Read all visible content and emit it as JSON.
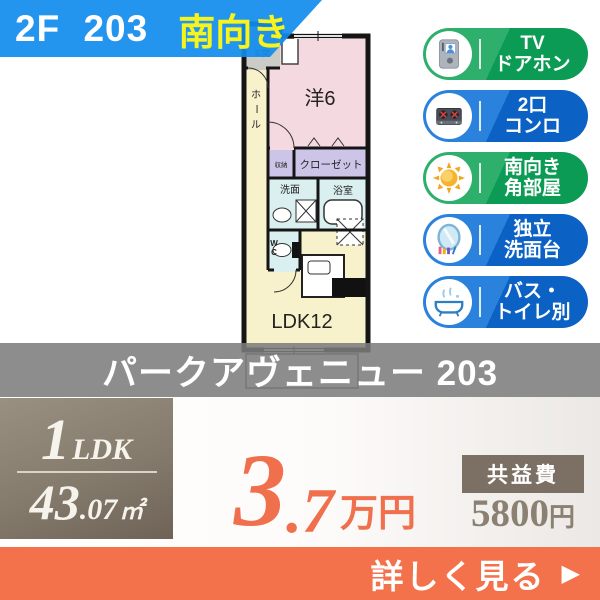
{
  "header": {
    "unit_label": "2F 203",
    "facing": "南向き"
  },
  "floorplan": {
    "rooms": {
      "entrance": "玄関",
      "hall": [
        "ホ",
        "ー",
        "ル"
      ],
      "western": "洋6",
      "storage": "収納",
      "closet": "クローゼット",
      "washroom": "洗面",
      "bath": "浴室",
      "wc": [
        "W",
        "C"
      ],
      "ldk": "LDK12"
    }
  },
  "features": [
    {
      "icon": "tv-doorphone",
      "color": "green",
      "lines": [
        "TV",
        "ドアホン"
      ]
    },
    {
      "icon": "two-burner-stove",
      "color": "blue",
      "lines": [
        "2口",
        "コンロ"
      ]
    },
    {
      "icon": "sun",
      "color": "green",
      "lines": [
        "南向き",
        "角部屋"
      ]
    },
    {
      "icon": "vanity-mirror",
      "color": "blue",
      "lines": [
        "独立",
        "洗面台"
      ]
    },
    {
      "icon": "bathtub",
      "color": "blue",
      "lines": [
        "バス・",
        "トイレ別"
      ]
    }
  ],
  "property": {
    "name": "パークアヴェニュー 203"
  },
  "summary": {
    "layout_num": "1",
    "layout_type": "LDK",
    "area_int": "43",
    "area_dec": ".07",
    "area_unit": "㎡",
    "rent_int": "3",
    "rent_dec": ".7",
    "rent_unit": "万円",
    "fee_label": "共益費",
    "fee_value": "5800",
    "fee_unit": "円"
  },
  "cta": {
    "label": "詳しく見る",
    "arrow": "▶"
  },
  "colors": {
    "banner_blue": "#118CEE",
    "facing_yellow": "#F6F31D",
    "badge_green": "#0C9B54",
    "badge_blue": "#0B62C4",
    "name_bar_gray": "#7C7C7C",
    "spec_taupe": "#857B6D",
    "rent_orange": "#F0704D",
    "cta_orange": "#F3724C",
    "room_pink": "#F5D9E1",
    "room_cream": "#F7F2CC",
    "room_lavender": "#CDC5E8",
    "room_cyan": "#DAEFEF"
  }
}
